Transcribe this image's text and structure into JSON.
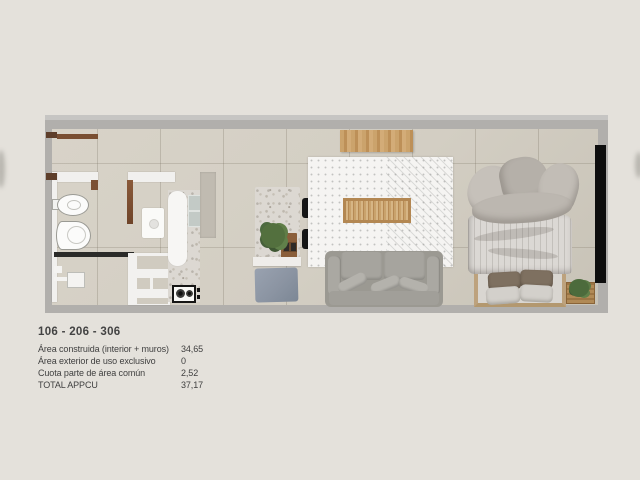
{
  "unit_info": {
    "title": "106 - 206 - 306",
    "rows": [
      {
        "label": "Área construida (interior + muros)",
        "value": "34,65"
      },
      {
        "label": "Área exterior de uso exclusivo",
        "value": "0"
      },
      {
        "label": "Cuota parte de área común",
        "value": "2,52"
      },
      {
        "label": "TOTAL APPCU",
        "value": "37,17"
      }
    ]
  },
  "floor_plan": {
    "type": "apartment-unit-top-view-render",
    "rooms": [
      "bathroom",
      "kitchen",
      "living-dining",
      "bedroom"
    ],
    "items": [
      "wall-shelf",
      "entry-door",
      "bidet",
      "toilet",
      "shower",
      "washing-machine",
      "kitchen-counter",
      "double-sink",
      "gas-stove",
      "open-shelving",
      "tall-cabinet",
      "breakfast-bar",
      "bar-stool",
      "potted-plant",
      "wooden-tray",
      "blue-pouf",
      "wall-mounted-table",
      "dotted-area-rug",
      "slatted-coffee-bench",
      "sofa",
      "double-bed",
      "bed-pillows",
      "wardrobe",
      "plant-crate"
    ],
    "colors": {
      "page_background": "#e4e1db",
      "wall": "#b1afac",
      "floor": "#d3cec3",
      "interior_wall": "#f1f0ee",
      "door_wood": "#8a5a3a",
      "light_wood": "#c69b63",
      "marble": "#dcd8d2",
      "sofa": "#9b9992",
      "bed_linen": "#c2bdb6",
      "pillow_dark": "#7e7060",
      "pouf_blue": "#8b94a2",
      "wardrobe_black": "#0e0e0e",
      "plant_green": "#53703e",
      "text": "#3f3f3f"
    }
  }
}
